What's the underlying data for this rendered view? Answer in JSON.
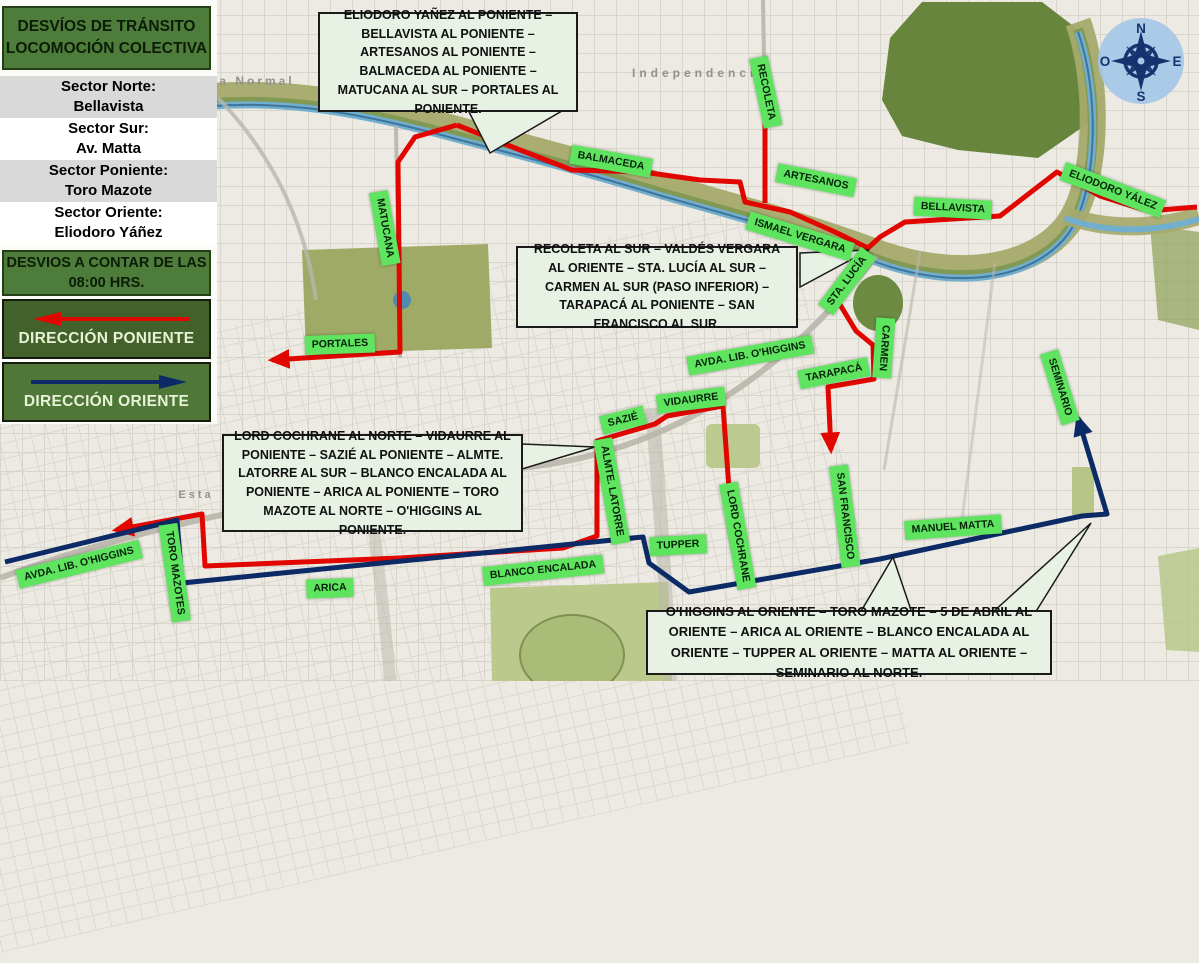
{
  "panel": {
    "title": "DESVÍOS DE TRÁNSITO LOCOMOCIÓN COLECTIVA",
    "sectors": [
      {
        "label": "Sector Norte:",
        "value": "Bellavista"
      },
      {
        "label": "Sector Sur:",
        "value": "Av. Matta"
      },
      {
        "label": "Sector Poniente:",
        "value": "Toro Mazote"
      },
      {
        "label": "Sector Oriente:",
        "value": "Eliodoro Yáñez"
      }
    ],
    "notice": "DESVIOS A CONTAR DE LAS 08:00 HRS.",
    "direction_west": "DIRECCIÓN PONIENTE",
    "direction_east": "DIRECCIÓN ORIENTE"
  },
  "callouts": [
    {
      "id": "north",
      "text": "ELIODORO YAÑEZ AL PONIENTE – BELLAVISTA AL PONIENTE – ARTESANOS AL PONIENTE – BALMACEDA AL PONIENTE – MATUCANA AL SUR – PORTALES AL PONIENTE."
    },
    {
      "id": "center",
      "text": "RECOLETA AL SUR – VALDÉS VERGARA AL ORIENTE – STA. LUCÍA AL SUR – CARMEN AL SUR (PASO INFERIOR) – TARAPACÁ AL PONIENTE – SAN FRANCISCO AL SUR."
    },
    {
      "id": "southwest",
      "text": "LORD COCHRANE AL NORTE – VIDAURRE AL PONIENTE – SAZIÉ AL PONIENTE – ALMTE. LATORRE AL SUR – BLANCO ENCALADA AL PONIENTE – ARICA AL PONIENTE – TORO MAZOTE AL NORTE – O'HIGGINS AL PONIENTE."
    },
    {
      "id": "southeast",
      "text": "O'HIGGINS AL ORIENTE – TORO MAZOTE – 5 DE ABRIL AL ORIENTE – ARICA AL ORIENTE – BLANCO ENCALADA AL ORIENTE – TUPPER AL ORIENTE – MATTA AL ORIENTE – SEMINARIO AL NORTE."
    }
  ],
  "street_labels": [
    {
      "text": "RECOLETA",
      "x": 766,
      "y": 92,
      "rot": 78
    },
    {
      "text": "BALMACEDA",
      "x": 611,
      "y": 161,
      "rot": 10
    },
    {
      "text": "ARTESANOS",
      "x": 816,
      "y": 180,
      "rot": 11
    },
    {
      "text": "BELLAVISTA",
      "x": 953,
      "y": 208,
      "rot": 3
    },
    {
      "text": "ELIODORO YÁLEZ",
      "x": 1113,
      "y": 190,
      "rot": 21
    },
    {
      "text": "ISMAEL VERGARA",
      "x": 800,
      "y": 236,
      "rot": 17
    },
    {
      "text": "STA. LUCÍA",
      "x": 847,
      "y": 281,
      "rot": -53
    },
    {
      "text": "CARMEN",
      "x": 884,
      "y": 348,
      "rot": 94
    },
    {
      "text": "AVDA. LIB. O'HIGGINS",
      "x": 750,
      "y": 355,
      "rot": -10
    },
    {
      "text": "TARAPACÁ",
      "x": 834,
      "y": 373,
      "rot": -11
    },
    {
      "text": "SEMINARIO",
      "x": 1060,
      "y": 387,
      "rot": 73
    },
    {
      "text": "VIDAURRE",
      "x": 691,
      "y": 400,
      "rot": -7
    },
    {
      "text": "SAZIÉ",
      "x": 623,
      "y": 420,
      "rot": -14
    },
    {
      "text": "ALMTE. LATORRE",
      "x": 612,
      "y": 491,
      "rot": 80
    },
    {
      "text": "LORD COCHRANE",
      "x": 738,
      "y": 536,
      "rot": 80
    },
    {
      "text": "SAN FRANCISCO",
      "x": 845,
      "y": 516,
      "rot": 83
    },
    {
      "text": "TUPPER",
      "x": 678,
      "y": 545,
      "rot": -3
    },
    {
      "text": "BLANCO ENCALADA",
      "x": 543,
      "y": 570,
      "rot": -6
    },
    {
      "text": "MANUEL MATTA",
      "x": 953,
      "y": 527,
      "rot": -4
    },
    {
      "text": "ARICA",
      "x": 330,
      "y": 588,
      "rot": -2
    },
    {
      "text": "TORO MAZOTES",
      "x": 175,
      "y": 573,
      "rot": 82
    },
    {
      "text": "AVDA. LIB. O'HIGGINS",
      "x": 79,
      "y": 564,
      "rot": -14
    },
    {
      "text": "PORTALES",
      "x": 340,
      "y": 344,
      "rot": -2
    },
    {
      "text": "MATUCANA",
      "x": 385,
      "y": 228,
      "rot": 80
    }
  ],
  "map_texts": [
    {
      "text": "Independencia",
      "x": 700,
      "y": 73,
      "ls": 4,
      "size": 12
    },
    {
      "text": "a Normal",
      "x": 257,
      "y": 81,
      "ls": 3,
      "size": 12
    },
    {
      "text": "Esta",
      "x": 196,
      "y": 495,
      "ls": 3,
      "size": 11
    }
  ],
  "compass": {
    "north": "N",
    "east": "E",
    "south": "S",
    "west": "O"
  },
  "routes": {
    "red": [
      {
        "points": [
          [
            457,
            125
          ],
          [
            520,
            150
          ],
          [
            572,
            170
          ],
          [
            643,
            172
          ],
          [
            700,
            180
          ],
          [
            740,
            182
          ],
          [
            745,
            202
          ],
          [
            790,
            212
          ],
          [
            835,
            232
          ],
          [
            868,
            248
          ],
          [
            880,
            237
          ],
          [
            905,
            222
          ],
          [
            1000,
            216
          ],
          [
            1057,
            172
          ],
          [
            1100,
            196
          ],
          [
            1148,
            211
          ],
          [
            1197,
            207
          ]
        ],
        "arrow": false
      },
      {
        "points": [
          [
            457,
            125
          ],
          [
            415,
            137
          ],
          [
            398,
            162
          ],
          [
            400,
            352
          ],
          [
            272,
            360
          ]
        ],
        "arrow": true
      },
      {
        "points": [
          [
            765,
            123
          ],
          [
            765,
            203
          ]
        ],
        "arrow": false
      },
      {
        "points": [
          [
            868,
            248
          ],
          [
            849,
            268
          ],
          [
            839,
            303
          ],
          [
            856,
            331
          ],
          [
            873,
            345
          ],
          [
            874,
            379
          ],
          [
            828,
            387
          ],
          [
            831,
            450
          ]
        ],
        "arrow": true
      },
      {
        "points": [
          [
            729,
            489
          ],
          [
            723,
            406
          ],
          [
            667,
            416
          ],
          [
            655,
            424
          ],
          [
            597,
            441
          ],
          [
            597,
            536
          ],
          [
            563,
            548
          ],
          [
            400,
            558
          ],
          [
            205,
            566
          ],
          [
            202,
            514
          ],
          [
            116,
            530
          ]
        ],
        "arrow": true
      }
    ],
    "navy": [
      {
        "points": [
          [
            5,
            562
          ],
          [
            177,
            520
          ],
          [
            182,
            583
          ],
          [
            643,
            537
          ],
          [
            649,
            563
          ],
          [
            689,
            592
          ],
          [
            880,
            559
          ],
          [
            1082,
            516
          ],
          [
            1107,
            514
          ],
          [
            1078,
            418
          ]
        ],
        "arrow": true
      }
    ]
  },
  "colors": {
    "route_red": "#e10600",
    "route_navy": "#0b2a66",
    "label_green": "#5fe45f",
    "panel_green": "#4d7c3b",
    "panel_dark_green": "#42612b",
    "callout_bg": "#e7f2e4",
    "compass_navy": "#16336f"
  }
}
